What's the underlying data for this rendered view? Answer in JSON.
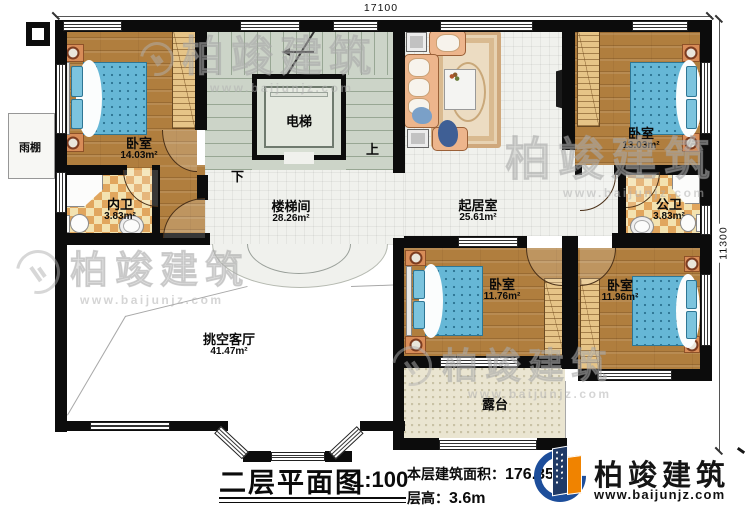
{
  "plan": {
    "dim_top": "17100",
    "dim_right": "11300",
    "up": "上",
    "down": "下"
  },
  "rooms": {
    "bedroom_tl": {
      "name": "卧室",
      "area": "14.03m²"
    },
    "inner_bath": {
      "name": "内卫",
      "area": "3.83m²"
    },
    "elevator": {
      "name": "电梯"
    },
    "stair_hall": {
      "name": "楼梯间",
      "area": "28.26m²"
    },
    "living": {
      "name": "起居室",
      "area": "25.61m²"
    },
    "bedroom_tr": {
      "name": "卧室",
      "area": "13.03m²"
    },
    "public_bath": {
      "name": "公卫",
      "area": "3.83m²"
    },
    "canopy": {
      "name": "雨棚"
    },
    "void_living": {
      "name": "挑空客厅",
      "area": "41.47m²"
    },
    "bedroom_bm": {
      "name": "卧室",
      "area": "11.76m²"
    },
    "bedroom_br": {
      "name": "卧室",
      "area": "11.96m²"
    },
    "terrace": {
      "name": "露台"
    }
  },
  "titleblock": {
    "title": "二层平面图",
    "scale": "1:100",
    "area_label": "本层建筑面积：",
    "area_value": "176.35m²",
    "floor_height_label": "层高：",
    "floor_height_value": "3.6m"
  },
  "brand": {
    "name": "柏竣建筑",
    "url": "www.baijunjz.com",
    "blue": "#1d4e9b",
    "orange": "#f08300"
  },
  "watermark": {
    "text": "柏竣建筑",
    "url": "www.baijunjz.com"
  }
}
